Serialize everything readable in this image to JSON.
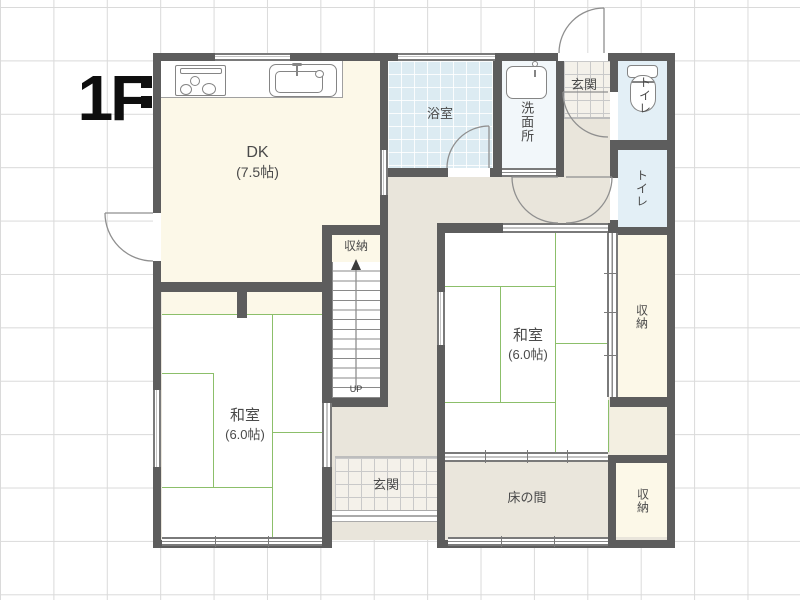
{
  "floor_label": "1F",
  "stairs": {
    "direction_label": "UP"
  },
  "rooms": {
    "dk": {
      "name": "DK",
      "size": "(7.5帖)"
    },
    "bathroom": {
      "name": "浴室"
    },
    "washroom": {
      "name": "洗面所"
    },
    "entrance_upper": {
      "name": "玄関"
    },
    "toilet_upper": {
      "name": "トイレ"
    },
    "toilet_lower": {
      "name": "トイレ"
    },
    "closet_east": {
      "name": "収納"
    },
    "closet_by_stairs": {
      "name": "収納"
    },
    "washitsu_east": {
      "name": "和室",
      "size": "(6.0帖)"
    },
    "washitsu_west": {
      "name": "和室",
      "size": "(6.0帖)"
    },
    "entrance_lower": {
      "name": "玄関"
    },
    "tokonoma": {
      "name": "床の間"
    },
    "closet_southeast": {
      "name": "収納"
    }
  },
  "colors": {
    "wall": "#5d5d5d",
    "hall_floor": "#e9e5db",
    "cream_floor": "#fcf8e8",
    "bath_blue": "#dcebf2",
    "toilet_blue": "#e3eff6",
    "washroom_floor": "#f2f7fa",
    "tile_floor": "#f4f1ea",
    "tatami_line": "#8cbf6a",
    "grid_line": "#dadada",
    "text": "#4a4a4a"
  }
}
